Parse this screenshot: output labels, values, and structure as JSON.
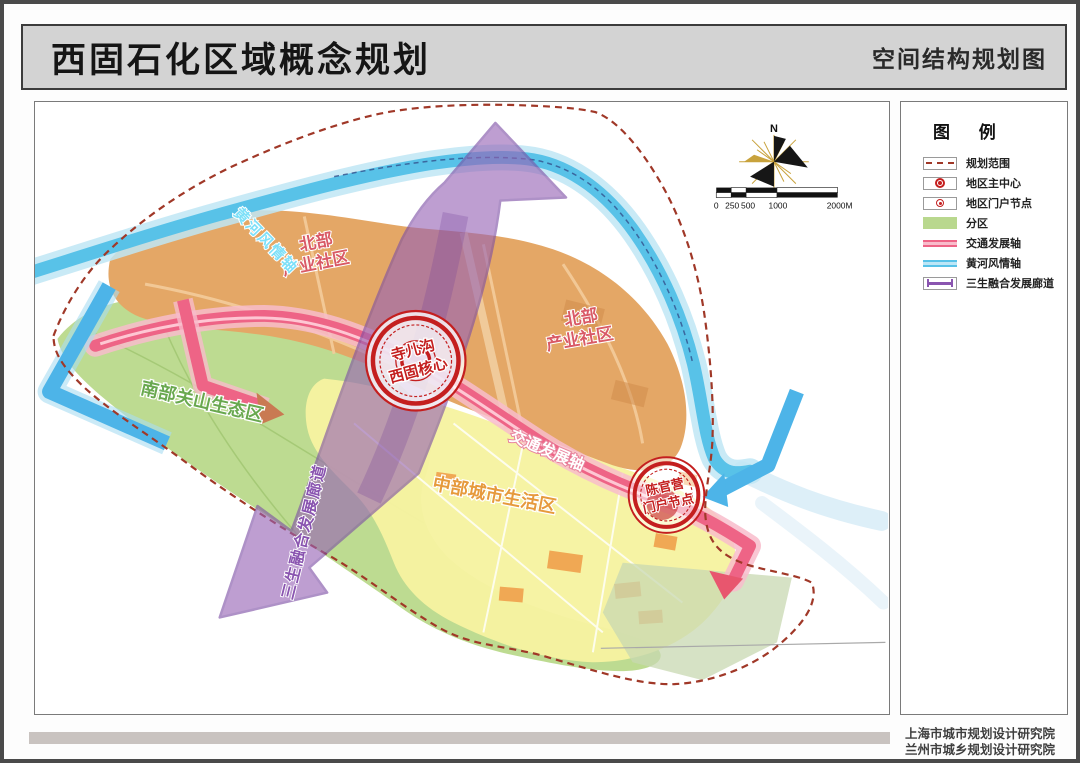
{
  "page": {
    "title": "西固石化区域概念规划",
    "subtitle": "空间结构规划图"
  },
  "legend": {
    "title": "图 例",
    "items": [
      {
        "label": "规划范围",
        "type": "dashed-boundary"
      },
      {
        "label": "地区主中心",
        "type": "main-center-node"
      },
      {
        "label": "地区门户节点",
        "type": "gateway-node"
      },
      {
        "label": "分区",
        "type": "district-fill",
        "color": "#b9d88e"
      },
      {
        "label": "交通发展轴",
        "type": "traffic-axis",
        "color": "#ee6486"
      },
      {
        "label": "黄河风情轴",
        "type": "river-axis",
        "color": "#58c2e8"
      },
      {
        "label": "三生融合发展廊道",
        "type": "corridor",
        "color": "#8a55b0"
      }
    ]
  },
  "map": {
    "compass_north_label": "N",
    "scale_bar": {
      "labels": [
        "0",
        "250",
        "500",
        "1000",
        "2000M"
      ]
    },
    "zones": {
      "north_industrial_1": {
        "line1": "北部",
        "line2": "产业社区"
      },
      "north_industrial_2": {
        "line1": "北部",
        "line2": "产业社区"
      },
      "south_ecological": {
        "label": "南部关山生态区"
      },
      "central_living": {
        "label": "中部城市生活区"
      }
    },
    "axes": {
      "traffic": {
        "label": "交通发展轴",
        "color": "#ee6486"
      },
      "river": {
        "label": "黄河风情轴",
        "color": "#58c2e8"
      },
      "corridor": {
        "label": "三生融合发展廊道",
        "color": "#8a55b0"
      }
    },
    "nodes": {
      "main_center": {
        "line1": "寺儿沟",
        "line2": "西固核心"
      },
      "gateway": {
        "line1": "陈官营",
        "line2": "门户节点"
      }
    }
  },
  "footer": {
    "line1": "上海市城市规划设计研究院",
    "line2": "兰州市城乡规划设计研究院"
  },
  "colors": {
    "industrial_zone": "#e4a766",
    "living_zone": "#f6f3a0",
    "ecological_zone": "#b9d98b",
    "river": "#58c2e8",
    "traffic_axis": "#ee6486",
    "corridor": "#9763b5",
    "boundary": "#a03828",
    "node_red": "#c41f1f"
  }
}
